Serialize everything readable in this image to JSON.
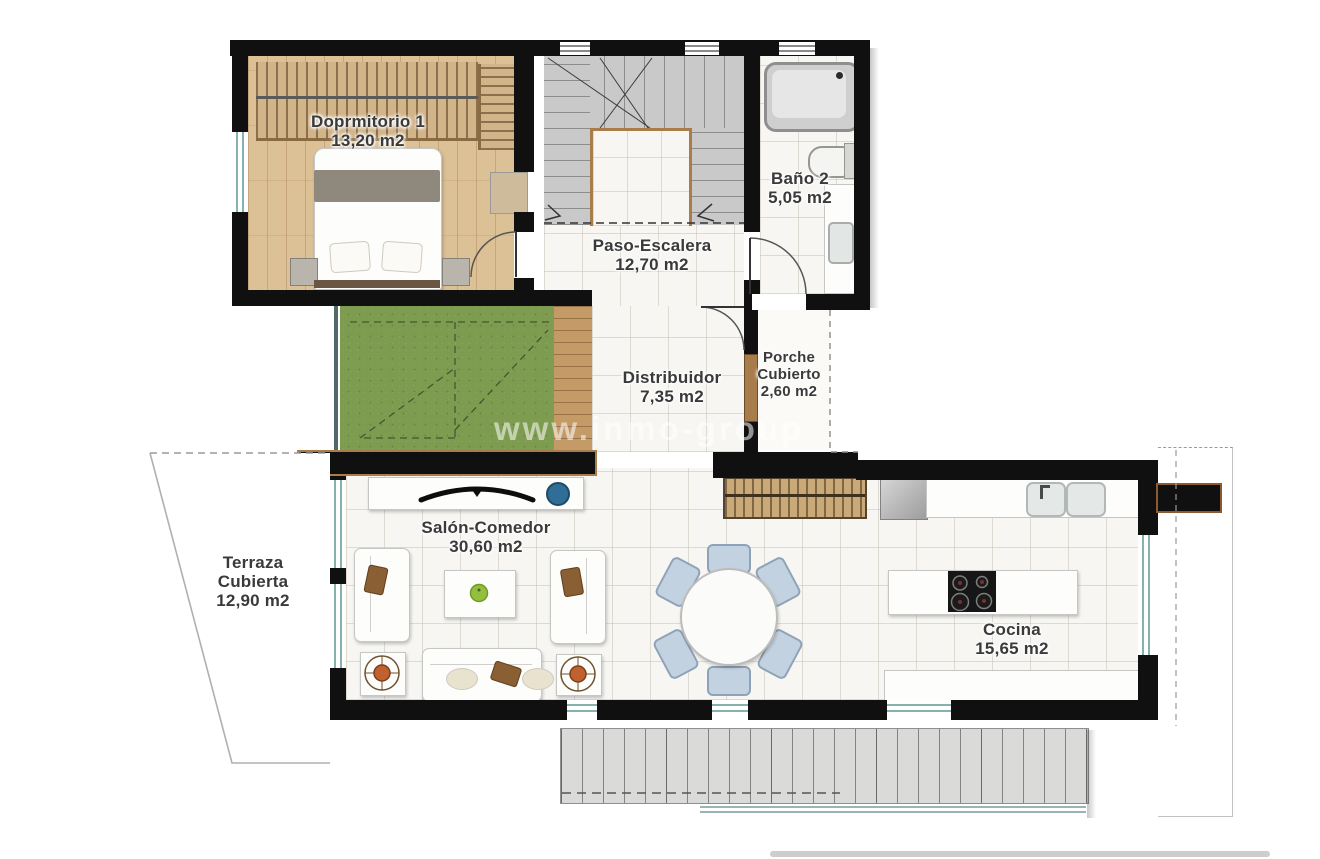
{
  "page": {
    "background": "#ffffff",
    "type": "floor-plan"
  },
  "watermark": {
    "text": "www.inmo-group"
  },
  "rooms": {
    "dormitorio": {
      "label": "Doprmitorio 1",
      "area": "13,20 m2"
    },
    "bano": {
      "label": "Baño 2",
      "area": "5,05 m2"
    },
    "paso": {
      "label": "Paso-Escalera",
      "area": "12,70 m2"
    },
    "distribuidor": {
      "label": "Distribuidor",
      "area": "7,35 m2"
    },
    "porche": {
      "label1": "Porche",
      "label2": "Cubierto",
      "area": "2,60 m2"
    },
    "salon": {
      "label": "Salón-Comedor",
      "area": "30,60 m2"
    },
    "terraza": {
      "label1": "Terraza",
      "label2": "Cubierta",
      "area": "12,90 m2"
    },
    "cocina": {
      "label": "Cocina",
      "area": "15,65 m2"
    }
  },
  "colors": {
    "wall": "#101010",
    "wood_floor": "#dcc096",
    "grass": "#7e9c4f",
    "tile": "#f7f6f2",
    "stair": "#c9c9c9",
    "wood_trim": "#a97c4b",
    "window": "#86b2ae",
    "chair": "#c3d2e0",
    "label_text": "#3a3a3a"
  }
}
